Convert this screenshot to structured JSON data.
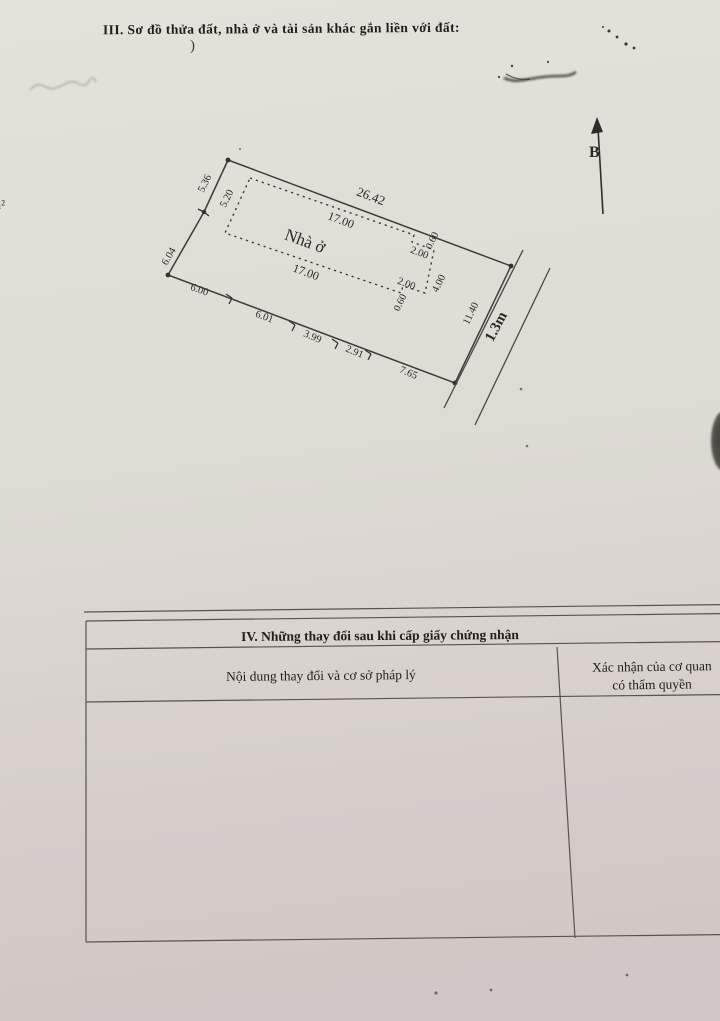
{
  "page": {
    "section3_title": "III. Sơ đồ thửa đất, nhà ở và tài sản khác gắn liền với đất:",
    "stray_paren": ")",
    "left_margin_fragment": "m²"
  },
  "diagram": {
    "north_label": "B",
    "house_label": {
      "text": "Nhà ở",
      "x": 305,
      "y": 241,
      "rot": 20,
      "size": 17,
      "bold": false
    },
    "alley_label": {
      "text": "1.3m",
      "x": 497,
      "y": 327,
      "rot": -62,
      "size": 15,
      "bold": true
    },
    "dimension_labels": [
      {
        "text": "26.42",
        "x": 371,
        "y": 196,
        "rot": 21,
        "size": 13
      },
      {
        "text": "17.00",
        "x": 341,
        "y": 220,
        "rot": 21,
        "size": 12
      },
      {
        "text": "17.00",
        "x": 306,
        "y": 272,
        "rot": 20,
        "size": 12
      },
      {
        "text": "2.00",
        "x": 419,
        "y": 254,
        "rot": 21,
        "size": 10.5
      },
      {
        "text": "0.60",
        "x": 433,
        "y": 241,
        "rot": -64,
        "size": 10
      },
      {
        "text": "2.00",
        "x": 406,
        "y": 285,
        "rot": 21,
        "size": 10.5
      },
      {
        "text": "0.60",
        "x": 401,
        "y": 303,
        "rot": -64,
        "size": 10
      },
      {
        "text": "4.00",
        "x": 440,
        "y": 284,
        "rot": -64,
        "size": 10.5
      },
      {
        "text": "5.36",
        "x": 206,
        "y": 184,
        "rot": -64,
        "size": 10.5
      },
      {
        "text": "5.20",
        "x": 228,
        "y": 199,
        "rot": -64,
        "size": 10.5
      },
      {
        "text": "6.04",
        "x": 170,
        "y": 257,
        "rot": -60,
        "size": 10.5
      },
      {
        "text": "6.00",
        "x": 199,
        "y": 291,
        "rot": 20,
        "size": 10.5
      },
      {
        "text": "6.01",
        "x": 264,
        "y": 318,
        "rot": 21,
        "size": 10.5
      },
      {
        "text": "3.99",
        "x": 312,
        "y": 338,
        "rot": 23,
        "size": 10.5
      },
      {
        "text": "2.91",
        "x": 354,
        "y": 353,
        "rot": 23,
        "size": 10.5
      },
      {
        "text": "7.65",
        "x": 408,
        "y": 374,
        "rot": 23,
        "size": 10.5
      },
      {
        "text": "11.40",
        "x": 472,
        "y": 314,
        "rot": -64,
        "size": 10.5
      }
    ]
  },
  "table": {
    "title": "IV. Những thay đổi sau khi cấp giấy chứng nhận",
    "col1_header": "Nội dung thay đổi và cơ sở pháp lý",
    "col2_header_line1": "Xác nhận của cơ quan",
    "col2_header_line2": "có thẩm quyền"
  }
}
